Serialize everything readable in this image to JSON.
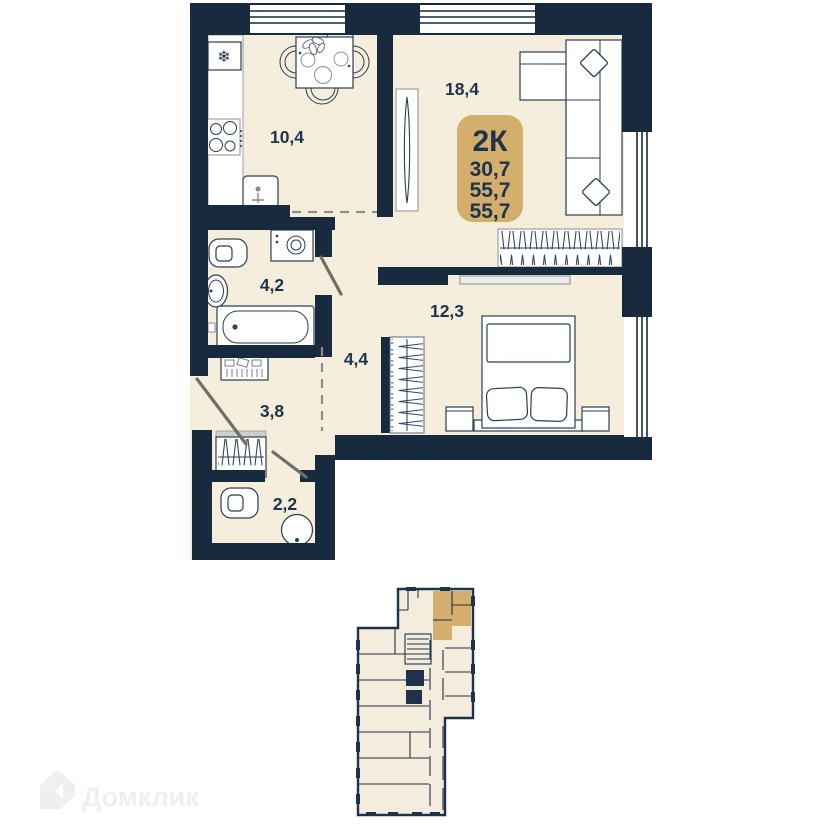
{
  "apartment": {
    "badge": {
      "type": "2К",
      "area_1": "30,7",
      "area_2": "55,7",
      "area_3": "55,7"
    },
    "rooms": {
      "living": "18,4",
      "kitchen": "10,4",
      "bedroom": "12,3",
      "bathroom": "4,2",
      "corridor": "4,4",
      "hall": "3,8",
      "wc": "2,2"
    },
    "icons": {
      "freezer": "❄"
    }
  },
  "minimap": {
    "highlight_color": "#d3ae6c"
  },
  "watermark": {
    "brand": "Домклик"
  },
  "colors": {
    "wall": "#172a3e",
    "floor": "#f6eedd",
    "accent": "#d3ae6c",
    "text": "#1d3349"
  }
}
